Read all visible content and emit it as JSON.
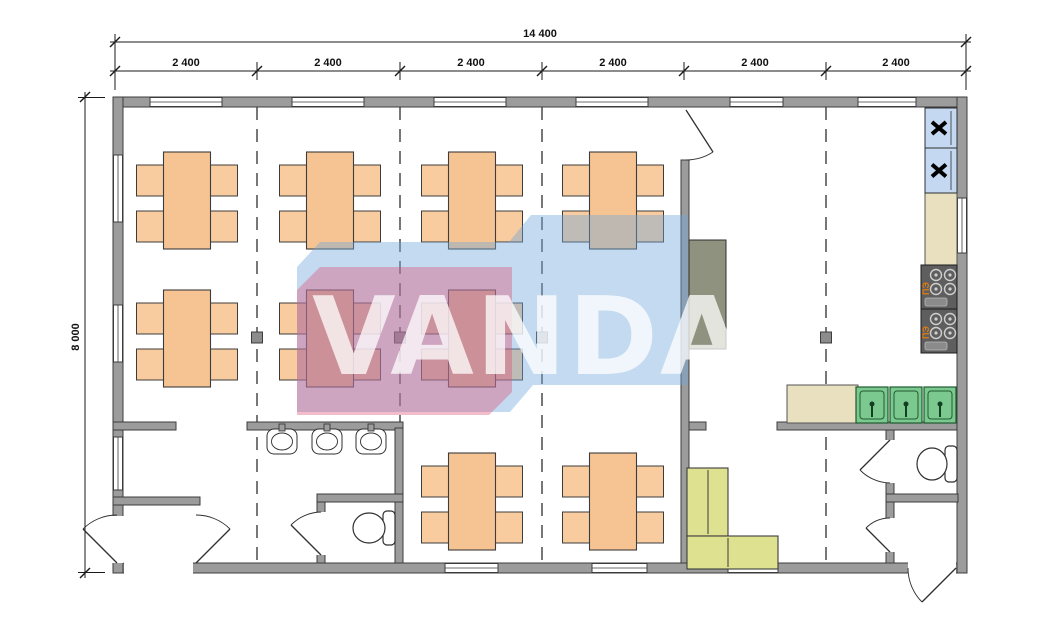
{
  "dims": {
    "total": "14 400",
    "modules": [
      "2 400",
      "2 400",
      "2 400",
      "2 400",
      "2 400",
      "2 400"
    ],
    "height": "8 000"
  },
  "watermark": {
    "text": "VANDA"
  },
  "appliances": {
    "stove_label": "ПЭ"
  },
  "colors": {
    "wall": "#9C9C9C",
    "wall_edge": "#3C3C3C",
    "table": "#F6C493",
    "chair": "#F8CC9F",
    "sofa": "#DEE18F",
    "sink_green": "#7CC98F",
    "counter": "#E8E0BF",
    "fridge_blue": "#C4D9F1",
    "stove_gray": "#5E5E5E",
    "cabinet": "#8F927E",
    "watermark_pink": "#E05070",
    "watermark_blue": "#6FA8DC",
    "dash": "#4A4A4A",
    "dim": "#1A1A1A",
    "stove_label_color": "#E07B10"
  },
  "furniture": {
    "table_size": {
      "w": 47,
      "h": 97
    },
    "chair_size": {
      "w": 29,
      "h": 31
    },
    "rows": [
      {
        "tableY": 152,
        "chairYs": [
          165,
          211
        ]
      },
      {
        "tableY": 290,
        "chairYs": [
          303,
          349
        ]
      },
      {
        "tableY": 453,
        "chairYs": [
          466,
          512
        ]
      }
    ],
    "tables": [
      {
        "cx": 187,
        "row": 0
      },
      {
        "cx": 330,
        "row": 0
      },
      {
        "cx": 472,
        "row": 0
      },
      {
        "cx": 613,
        "row": 0
      },
      {
        "cx": 187,
        "row": 1
      },
      {
        "cx": 330,
        "row": 1
      },
      {
        "cx": 472,
        "row": 1
      },
      {
        "cx": 472,
        "row": 2
      },
      {
        "cx": 613,
        "row": 2
      }
    ],
    "wash_basins": [
      {
        "cx": 282
      },
      {
        "cx": 327
      },
      {
        "cx": 371
      }
    ],
    "kitchen_sinks": [
      {
        "x": 856
      },
      {
        "x": 890
      },
      {
        "x": 924
      }
    ],
    "fridges": [
      {
        "y": 108,
        "h": 40
      },
      {
        "y": 148,
        "h": 45
      }
    ],
    "stoves": [
      {
        "y": 265
      },
      {
        "y": 309
      }
    ],
    "toilets": [
      {
        "bowl_cx": 932,
        "bowl_cy": 464,
        "rx": 15,
        "ry": 16,
        "tank_x": 945,
        "tank_y": 446,
        "tank_w": 12,
        "tank_h": 36
      },
      {
        "bowl_cx": 369,
        "bowl_cy": 528,
        "rx": 16,
        "ry": 15,
        "tank_x": 383,
        "tank_y": 511,
        "tank_w": 12,
        "tank_h": 34
      }
    ]
  }
}
